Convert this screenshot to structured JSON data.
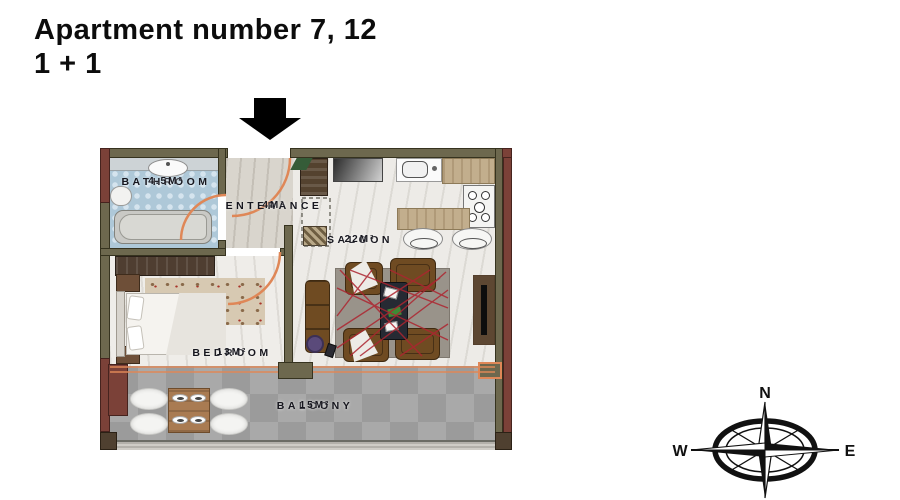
{
  "title": {
    "line1": "Apartment number 7, 12",
    "line2": "1 + 1"
  },
  "floorplan": {
    "rooms": [
      {
        "name": "BATHROOM",
        "area": "4.5M²"
      },
      {
        "name": "ENTERANCE",
        "area": "4M²"
      },
      {
        "name": "SALOON",
        "area": "22M²"
      },
      {
        "name": "BEDROOM",
        "area": "13M²"
      },
      {
        "name": "BALCONY",
        "area": "15M²"
      }
    ]
  },
  "compass": {
    "north": "N",
    "east": "E",
    "south": "S",
    "west": "W"
  },
  "colors": {
    "wall": "#6d684e",
    "wall_accent": "#7b4138",
    "door_arc": "#df8757",
    "bathroom_floor": "#aec8d8",
    "balcony_floor": "#a9a9a9",
    "rug_red": "#ad2530",
    "label_text": "#16161e",
    "title_text": "#0c0c0c"
  }
}
